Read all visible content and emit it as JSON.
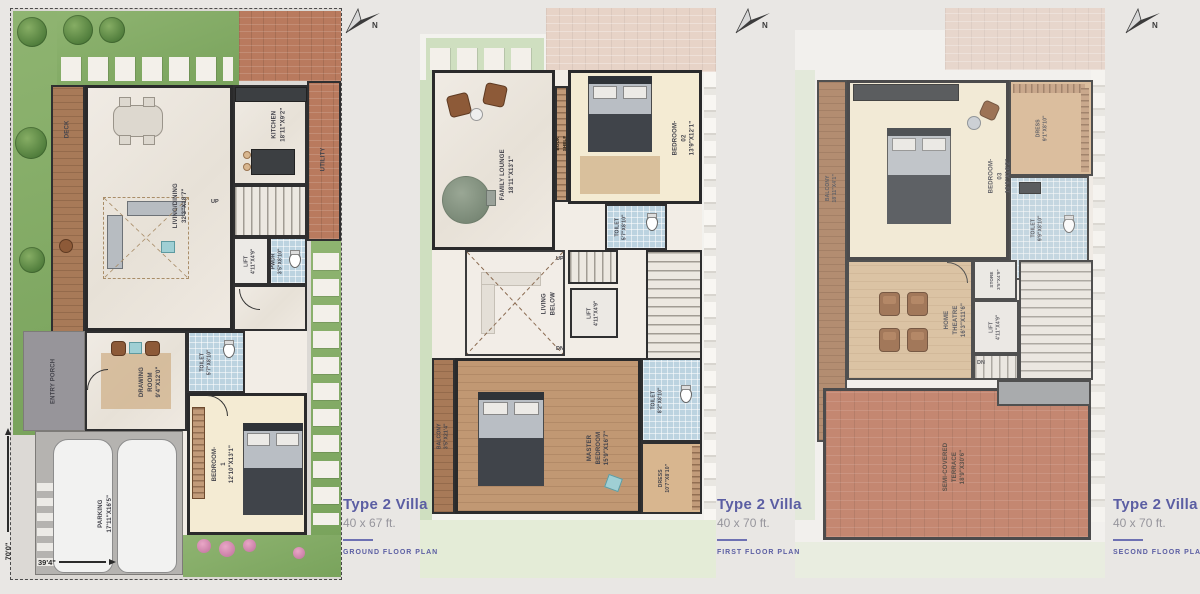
{
  "north": "N",
  "dims": {
    "vertical": "70'0\"",
    "horizontal": "39'4\""
  },
  "captions": [
    {
      "title": "Type 2 Villa",
      "size": "40 x 67 ft.",
      "plan": "GROUND FLOOR PLAN"
    },
    {
      "title": "Type 2 Villa",
      "size": "40 x 70 ft.",
      "plan": "FIRST FLOOR PLAN"
    },
    {
      "title": "Type 2 Villa",
      "size": "40 x 70 ft.",
      "plan": "SECOND FLOOR PLAN"
    }
  ],
  "ground": {
    "utility": "UTILITY",
    "deck": "DECK",
    "kitchen": "KITCHEN\n18'11\"X9'2\"",
    "living": "LIVING/DINING\n32'3\"X18'7\"",
    "up": "UP",
    "lift": "LIFT\n4'11\"X4'9\"",
    "pwdr": "PWDR\n3'5\"X8'10\"",
    "toilet": "TOILET\n5'7\"X8'10\"",
    "drawing": "DRAWING ROOM\n9'4\"X12'0\"",
    "entry": "ENTRY PORCH",
    "bedroom": "BEDROOM-1\n12'10\"X13'1\"",
    "parking": "PARKING\n17'11\"X16'5\""
  },
  "first": {
    "family": "FAMILY LOUNGE\n18'11\"X13'1\"",
    "bookshelf": "BOOK SHELF",
    "bedroom2": "BEDROOM-02\n13'9\"X12'1\"",
    "toilet_a": "TOILET\n5'7\"X8'10\"",
    "living_below": "LIVING BELOW",
    "up": "UP",
    "dn": "DN",
    "lift": "LIFT\n4'11\"X4'9\"",
    "balcony": "BALCONY\n3'5\"X21'4\"",
    "master": "MASTER BEDROOM\n15'9\"X16'7\"",
    "toilet_b": "TOILET\n8'2\"X8'10\"",
    "dress": "DRESS\n10'7\"X8'10\""
  },
  "second": {
    "balcony": "BALCONY\n18'11\"X4'1\"",
    "bedroom3": "BEDROOM-03\n15'9\"X16'2\"",
    "dress": "DRESS\n9'1\"X8'10\"",
    "toilet": "TOILET\n9'9\"X8'10\"",
    "theatre": "HOME THEATRE\n16'3\"X11'6\"",
    "store": "STORE\n3'5\"X4'9\"",
    "lift": "LIFT\n4'11\"X4'9\"",
    "dn": "DN",
    "terrace": "SEMI-COVERED TERRACE\n18'9\"X30'6\""
  }
}
